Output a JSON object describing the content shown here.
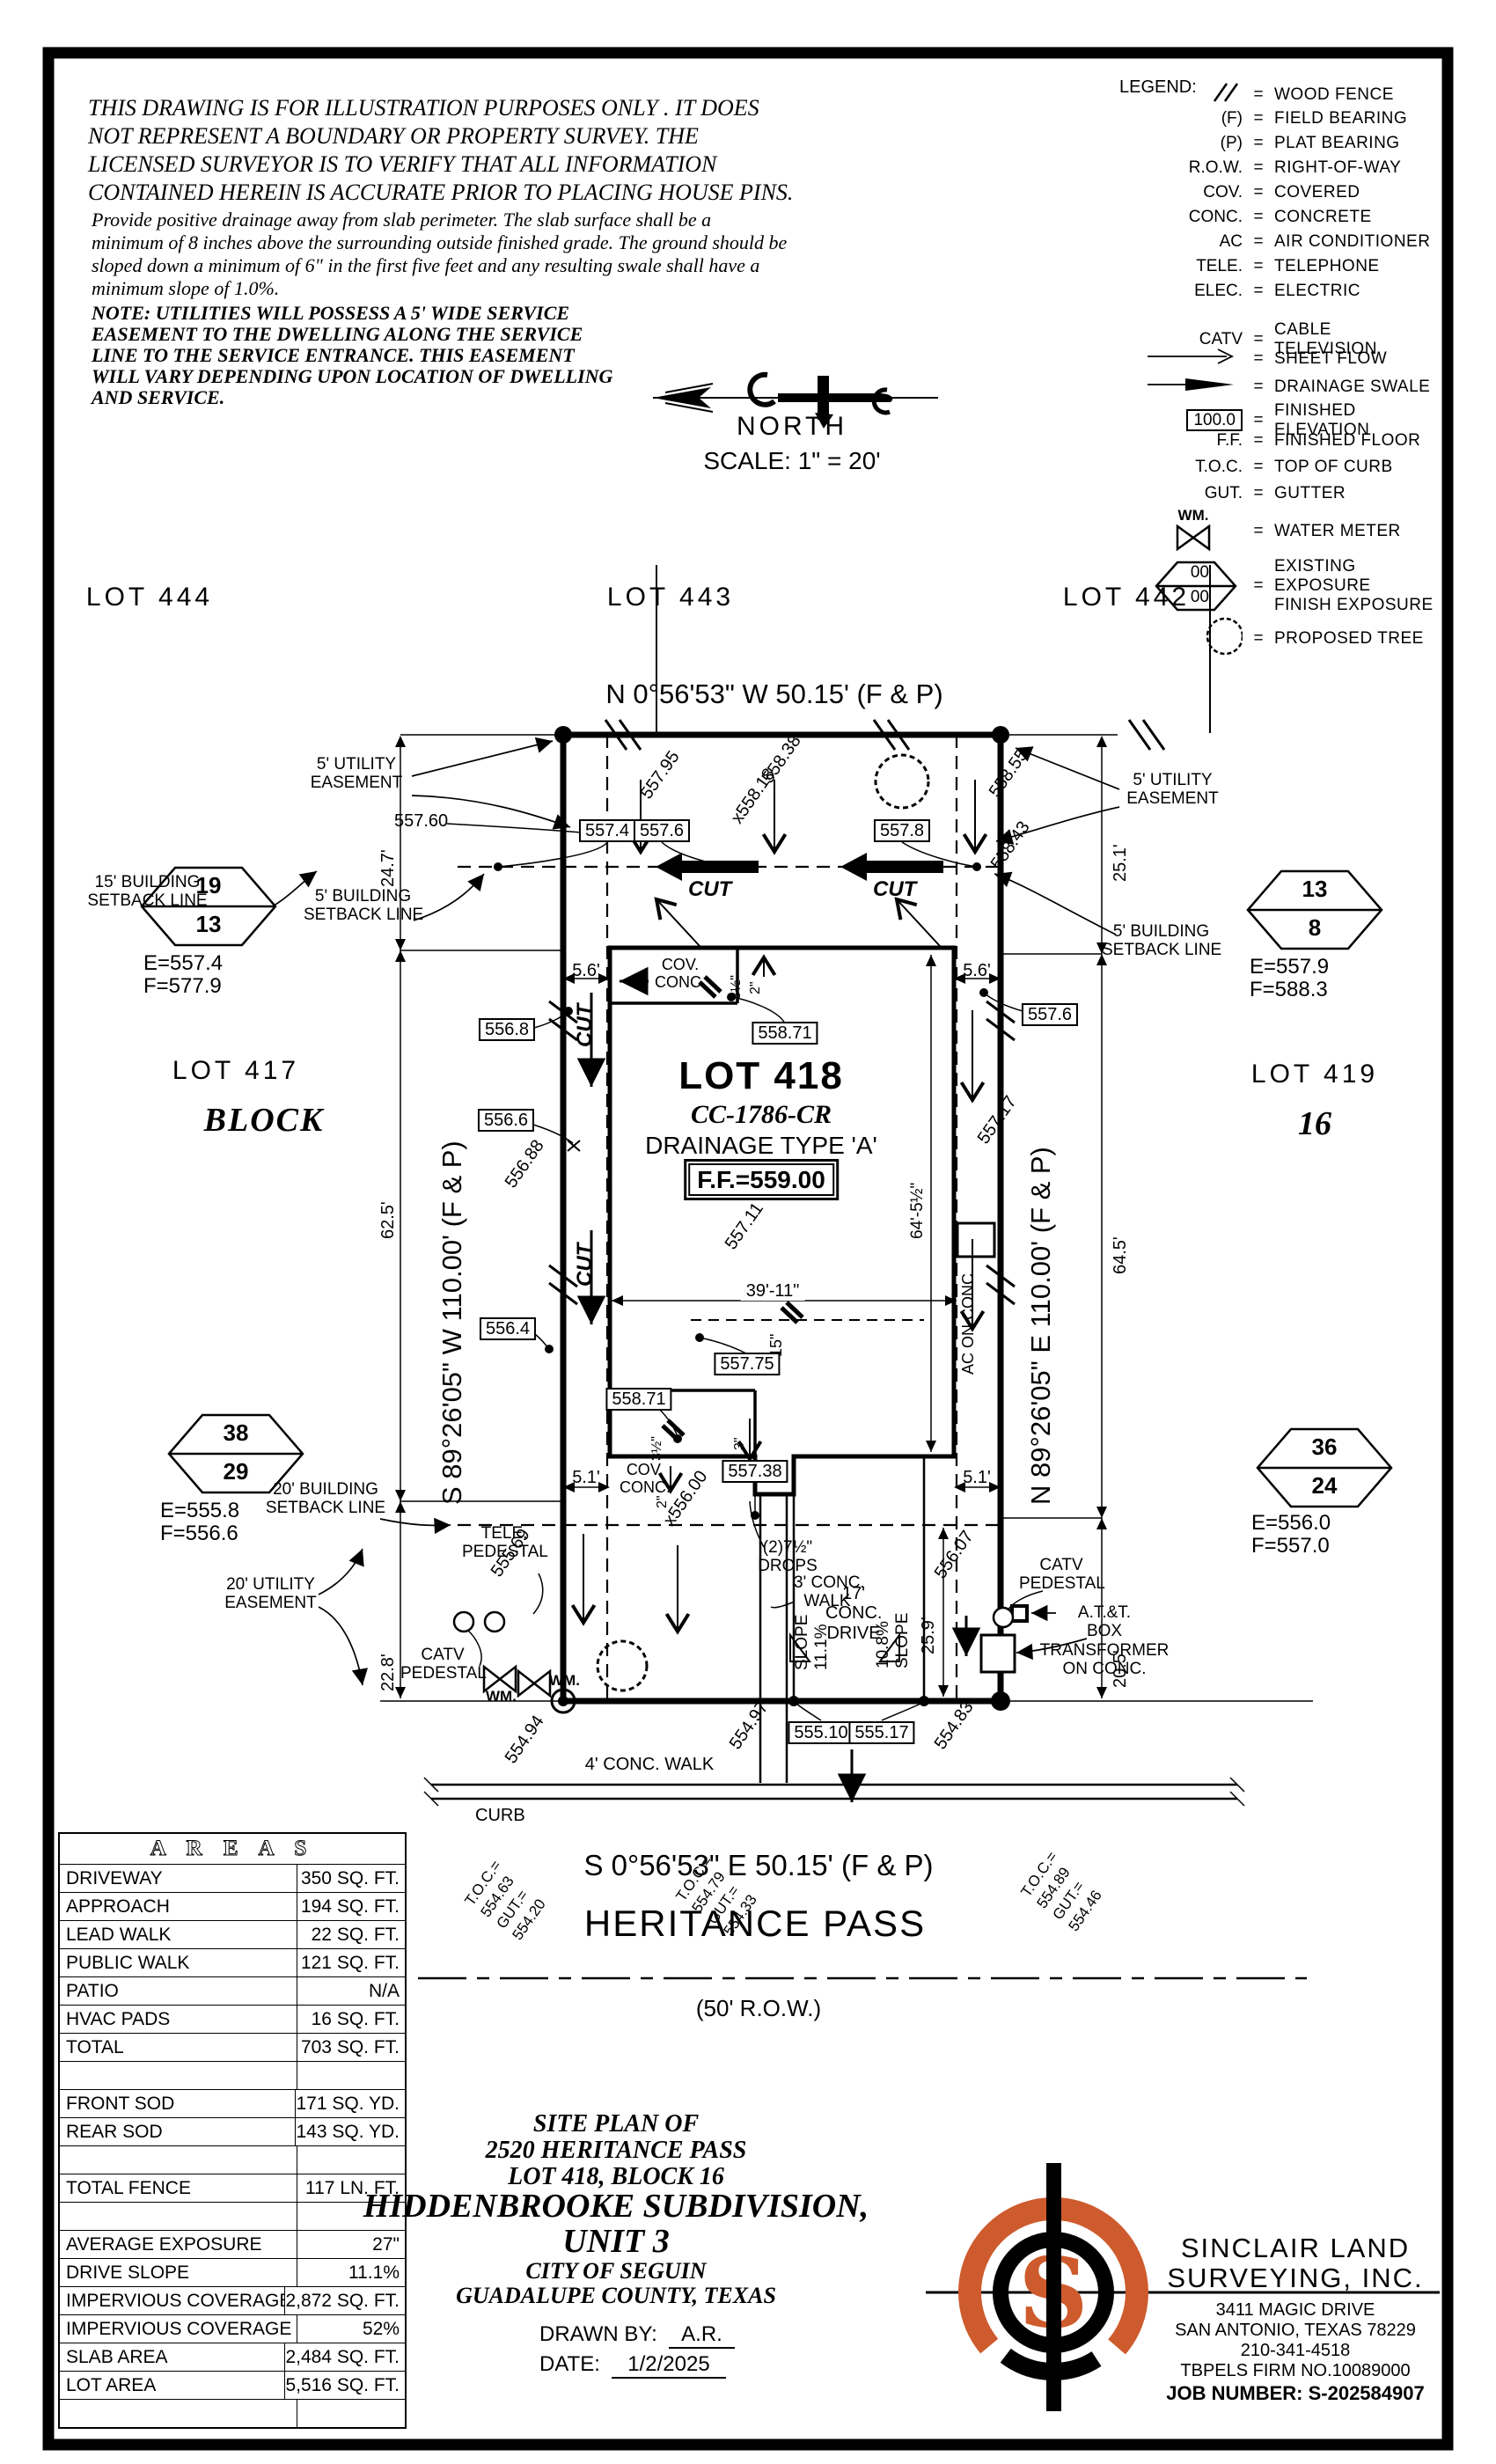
{
  "colors": {
    "accent": "#CE5B2D",
    "ink": "#000000",
    "paper": "#ffffff"
  },
  "disclaimer": {
    "para1": [
      "THIS DRAWING IS FOR ILLUSTRATION PURPOSES ONLY . IT DOES",
      "NOT REPRESENT A BOUNDARY OR PROPERTY SURVEY. THE",
      "LICENSED SURVEYOR IS TO VERIFY THAT ALL INFORMATION",
      "CONTAINED HEREIN IS ACCURATE PRIOR TO PLACING HOUSE PINS."
    ],
    "para2": [
      "Provide positive drainage away from slab perimeter. The slab surface shall be a",
      "minimum of 8 inches above the surrounding outside finished grade. The ground should be",
      "sloped down a minimum of 6\" in the first five feet and any resulting swale shall have a",
      "minimum slope of 1.0%."
    ],
    "note": [
      "NOTE: UTILITIES WILL POSSESS A 5' WIDE SERVICE",
      "EASEMENT TO THE DWELLING ALONG THE SERVICE",
      "LINE TO THE SERVICE ENTRANCE. THIS EASEMENT",
      "WILL VARY DEPENDING UPON LOCATION OF DWELLING",
      "AND SERVICE."
    ]
  },
  "legend": {
    "title": "LEGEND:",
    "eq": "=",
    "wood_fence": "WOOD FENCE",
    "f_sym": "(F)",
    "f": "FIELD BEARING",
    "p_sym": "(P)",
    "p": "PLAT BEARING",
    "row_sym": "R.O.W.",
    "row": "RIGHT-OF-WAY",
    "cov_sym": "COV.",
    "cov": "COVERED",
    "conc_sym": "CONC.",
    "conc": "CONCRETE",
    "ac_sym": "AC",
    "ac": "AIR CONDITIONER",
    "tele_sym": "TELE.",
    "tele": "TELEPHONE",
    "elec_sym": "ELEC.",
    "elec": "ELECTRIC",
    "catv_sym": "CATV",
    "catv": "CABLE TELEVISION",
    "sheet": "SHEET FLOW",
    "swale": "DRAINAGE SWALE",
    "fin_sym": "100.0",
    "fin": "FINISHED ELEVATION",
    "ff_sym": "F.F.",
    "ff": "FINISHED FLOOR",
    "toc_sym": "T.O.C.",
    "toc": "TOP OF CURB",
    "gut_sym": "GUT.",
    "gut": "GUTTER",
    "wm_sym": "WM.",
    "wm": "WATER METER",
    "exp_top": "00",
    "exp_bot": "00",
    "exp1": "EXISTING EXPOSURE",
    "exp2": "FINISH EXPOSURE",
    "tree": "PROPOSED TREE"
  },
  "north": {
    "label": "NORTH",
    "scale": "SCALE:  1\" =  20'"
  },
  "lots": {
    "l444": "LOT 444",
    "l443": "LOT 443",
    "l442": "LOT 442",
    "l417": "LOT 417",
    "block": "BLOCK",
    "l419": "LOT 419",
    "block16": "16"
  },
  "bearings": {
    "n": "N 0°56'53\" W  50.15'  (F & P)",
    "s": "S 0°56'53\" E  50.15'  (F & P)",
    "w": "S 89°26'05\" W  110.00'  (F & P)",
    "e": "N 89°26'05\" E  110.00'  (F & P)"
  },
  "street": {
    "name": "HERITANCE PASS",
    "row": "(50' R.O.W.)",
    "walk": "4' CONC. WALK",
    "curb": "CURB"
  },
  "house": {
    "lot": "LOT 418",
    "cc": "CC-1786-CR",
    "drainage": "DRAINAGE TYPE 'A'",
    "ff": "F.F.=559.00",
    "cov1": "COV.",
    "cov2": "CONC.",
    "ac": "AC ON CONC."
  },
  "markers": [
    {
      "a": "19",
      "b": "13",
      "e": "E=557.4",
      "f": "F=577.9"
    },
    {
      "a": "13",
      "b": "8",
      "e": "E=557.9",
      "f": "F=588.3"
    },
    {
      "a": "38",
      "b": "29",
      "e": "E=555.8",
      "f": "F=556.6"
    },
    {
      "a": "36",
      "b": "24",
      "e": "E=556.0",
      "f": "F=557.0"
    }
  ],
  "easements": {
    "u5a": "5' UTILITY",
    "u5b": "EASEMENT",
    "b15a": "15' BUILDING",
    "b15b": "SETBACK LINE",
    "b5a": "5' BUILDING",
    "b5b": "SETBACK LINE",
    "b20a": "20' BUILDING",
    "b20b": "SETBACK LINE",
    "u20a": "20' UTILITY",
    "u20b": "EASEMENT"
  },
  "cut": "CUT",
  "boxed": {
    "v5574": "557.4",
    "v5576": "557.6",
    "v5578": "557.8",
    "v5568": "556.8",
    "v5566": "556.6",
    "v5564": "556.4",
    "v55871r": "558.71",
    "v5576r": "557.6",
    "v55775": "557.75",
    "v55871f": "558.71",
    "v55738": "557.38",
    "v55510": "555.10",
    "v55517": "555.17"
  },
  "spots": {
    "v55795": "557.95",
    "v55838": "558.38",
    "v55818": "x558.18",
    "v55855": "558.55",
    "v55843": "558.43",
    "v55760": "557.60",
    "v55688": "556.88",
    "v55711": "557.11",
    "v55717": "557.17",
    "v55569": "555.69",
    "v55494": "554.94",
    "v55600": "x556.00",
    "v55607": "556.07",
    "v55483": "554.83",
    "v55497": "554.97"
  },
  "dims": {
    "d247": "24.7'",
    "d625": "62.5'",
    "d228": "22.8'",
    "d251": "25.1'",
    "d645": "64.5'",
    "d205": "20.5'",
    "d56": "5.6'",
    "d51": "5.1'",
    "d3911": "39'-11\"",
    "d6455": "64'-5½\"",
    "d259": "25.9'",
    "d35": "3½\"",
    "d2": "2\"",
    "d15": "15\"",
    "d3": "3\"",
    "drops1": "(2)7½\"",
    "drops2": "DROPS",
    "walk3a": "3' CONC.",
    "walk3b": "WALK",
    "slope": "SLOPE",
    "s111": "11.1%",
    "s108": "10.8%",
    "drive1": "17'",
    "drive2": "CONC.",
    "drive3": "DRIVE"
  },
  "utilities": {
    "tele1": "TELE.",
    "tele2": "PEDESTAL",
    "catv1": "CATV",
    "catv2": "PEDESTAL",
    "wm": "WM.",
    "att1": "A.T.&T.",
    "att2": "BOX",
    "att3": "TRANSFORMER",
    "att4": "ON CONC."
  },
  "toc_groups": [
    {
      "l1": "T.O.C.=",
      "l2": "554.63",
      "l3": "GUT.=",
      "l4": "554.20"
    },
    {
      "l1": "T.O.C.=",
      "l2": "554.79",
      "l3": "GUT.=",
      "l4": "554.33"
    },
    {
      "l1": "T.O.C.=",
      "l2": "554.89",
      "l3": "GUT.=",
      "l4": "554.46"
    }
  ],
  "areas": {
    "title": "A R E A S",
    "rows": [
      {
        "label": "DRIVEWAY",
        "value": "350 SQ. FT."
      },
      {
        "label": "APPROACH",
        "value": "194 SQ. FT."
      },
      {
        "label": "LEAD WALK",
        "value": "22 SQ. FT."
      },
      {
        "label": "PUBLIC WALK",
        "value": "121 SQ. FT."
      },
      {
        "label": "PATIO",
        "value": "N/A"
      },
      {
        "label": "HVAC PADS",
        "value": "16 SQ. FT."
      },
      {
        "label": "TOTAL",
        "value": "703 SQ. FT."
      },
      {
        "label": "",
        "value": ""
      },
      {
        "label": "FRONT SOD",
        "value": "171 SQ. YD."
      },
      {
        "label": "REAR SOD",
        "value": "143 SQ. YD."
      },
      {
        "label": "",
        "value": ""
      },
      {
        "label": "TOTAL FENCE",
        "value": "117 LN. FT."
      },
      {
        "label": "",
        "value": ""
      },
      {
        "label": "AVERAGE EXPOSURE",
        "value": "27\""
      },
      {
        "label": "DRIVE SLOPE",
        "value": "11.1%"
      },
      {
        "label": "IMPERVIOUS COVERAGE",
        "value": "2,872 SQ. FT."
      },
      {
        "label": "IMPERVIOUS COVERAGE %",
        "value": "52%"
      },
      {
        "label": "SLAB AREA",
        "value": "2,484 SQ. FT."
      },
      {
        "label": "LOT AREA",
        "value": "5,516 SQ. FT."
      },
      {
        "label": "",
        "value": ""
      }
    ]
  },
  "title_block": {
    "l1": "SITE PLAN OF",
    "l2": "2520 HERITANCE PASS",
    "l3": "LOT 418, BLOCK 16",
    "l4": "HIDDENBROOKE SUBDIVISION,",
    "l5": "UNIT 3",
    "l6": "CITY OF SEGUIN",
    "l7": "GUADALUPE COUNTY, TEXAS",
    "drawn_label": "DRAWN BY:",
    "drawn": "A.R.",
    "date_label": "DATE:",
    "date": "1/2/2025"
  },
  "firm": {
    "logo_letter": "S",
    "name1": "SINCLAIR LAND",
    "name2": "SURVEYING, INC.",
    "addr1": "3411 MAGIC DRIVE",
    "addr2": "SAN ANTONIO, TEXAS 78229",
    "phone": "210-341-4518",
    "firmno": "TBPELS FIRM NO.10089000",
    "job": "JOB NUMBER: S-202584907"
  }
}
